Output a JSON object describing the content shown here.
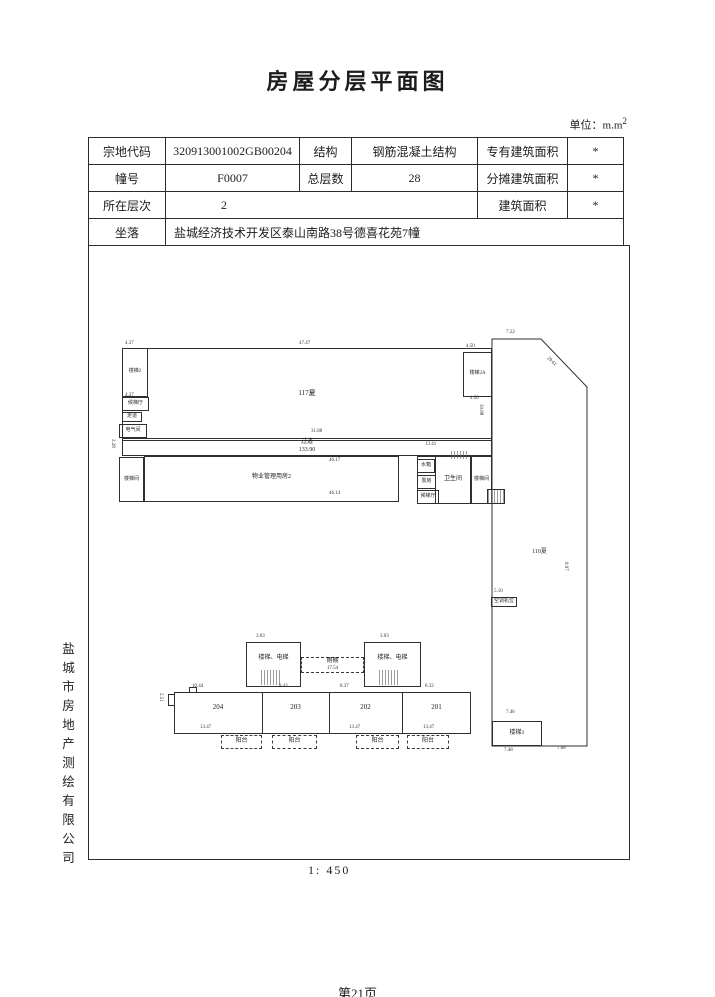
{
  "title": "房屋分层平面图",
  "unit_note": {
    "base": "单位：m.m",
    "sup": "2"
  },
  "info_table": {
    "rows": [
      {
        "c1": "宗地代码",
        "c2": "320913001002GB00204",
        "c3": "结构",
        "c4": "钢筋混凝土结构",
        "c5": "专有建筑面积",
        "c6": "*"
      },
      {
        "c1": "幢号",
        "c2": "F0007",
        "c3": "总层数",
        "c4": "28",
        "c5": "分摊建筑面积",
        "c6": "*"
      },
      {
        "c1": "所在层次",
        "c2": "2",
        "c5": "建筑面积",
        "c6": "*"
      },
      {
        "c1": "坐落",
        "c2": "盐城经济技术开发区泰山南路38号德喜花苑7幢"
      }
    ]
  },
  "plan": {
    "labels": {
      "hall": "117夏",
      "tl_stair": "楼梯2",
      "tr_stair": "楼梯2A",
      "lobby_left": "候梯厅",
      "aisle_left": "走道",
      "elec_left": "电气间",
      "corridor": "过道",
      "corridor_area": "133.90",
      "wuye": "物业管理用房2",
      "bl_stair": "楼梯间",
      "water_tank": "水箱",
      "pump": "泵房",
      "lobby_mid": "候梯厅",
      "wc": "卫生间",
      "mid_stair": "楼梯间",
      "void_right": "110夏",
      "ac": "空调机位",
      "stair1": "楼梯1",
      "block_label": "楼梯、电梯",
      "canopy": "雨棚",
      "canopy_area": "17.54"
    },
    "units": [
      "204",
      "203",
      "202",
      "201"
    ],
    "balconies": [
      "阳台",
      "阳台",
      "阳台",
      "阳台"
    ],
    "dims": [
      "4.37",
      "47.47",
      "4.50",
      "4.37",
      "4.50",
      "31.88",
      "13.41",
      "46.17",
      "46.14",
      "7.22",
      "29.61",
      "30.88",
      "8.97",
      "5.10",
      "7.46",
      "7.48",
      "7.08",
      "3.03",
      "3.03",
      "10.44",
      "8.42",
      "8.37",
      "8.32",
      "13.47",
      "13.47",
      "13.47",
      "2.51",
      "2.28"
    ]
  },
  "footer": {
    "scale": "1: 450",
    "page": "第21页"
  },
  "sidebar": {
    "company": "盐城市房地产测绘有限公司"
  }
}
